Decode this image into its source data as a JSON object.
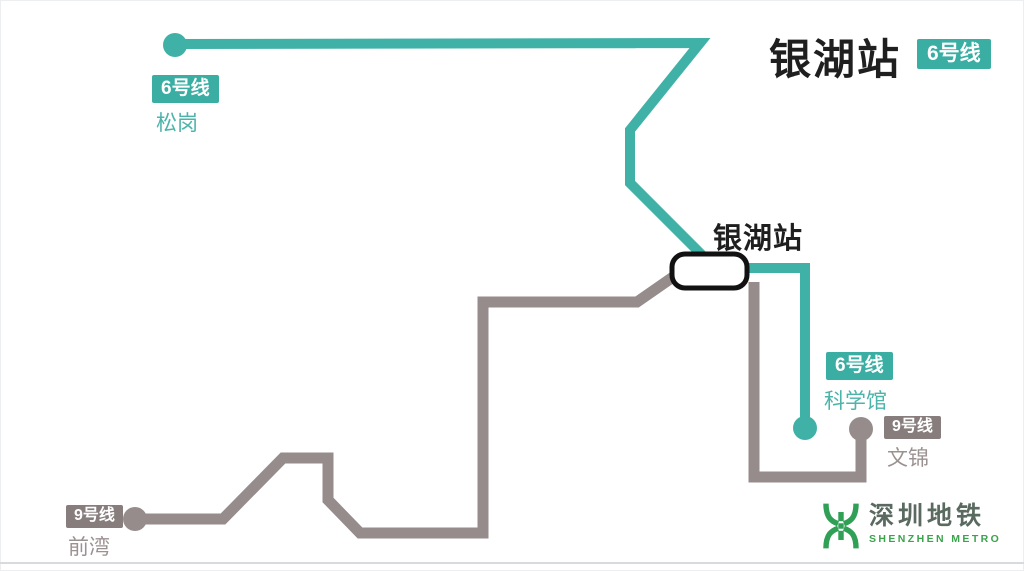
{
  "header": {
    "title": "银湖站",
    "title_badge": "6号线"
  },
  "station": {
    "label": "银湖站"
  },
  "line6": {
    "badge": "6号线",
    "west_terminus": "松岗",
    "east_terminus": "科学馆"
  },
  "line9": {
    "badge": "9号线",
    "west_terminus": "前湾",
    "east_terminus": "文锦"
  },
  "logo": {
    "cn": "深圳地铁",
    "en": "SHENZHEN METRO"
  },
  "colors": {
    "line6": "#3fb1a6",
    "line9": "#968c8c",
    "line6_badge_bg": "#3aaea3",
    "line9_badge_bg": "#877d7d",
    "line6_text": "#4db4aa",
    "line9_text": "#9b9191",
    "title_text": "#1f1f1f",
    "station_marker_border": "#121212",
    "logo_green": "#2fa055",
    "logo_cn_text": "#5a6a61",
    "logo_en_text": "#3aa34c"
  }
}
